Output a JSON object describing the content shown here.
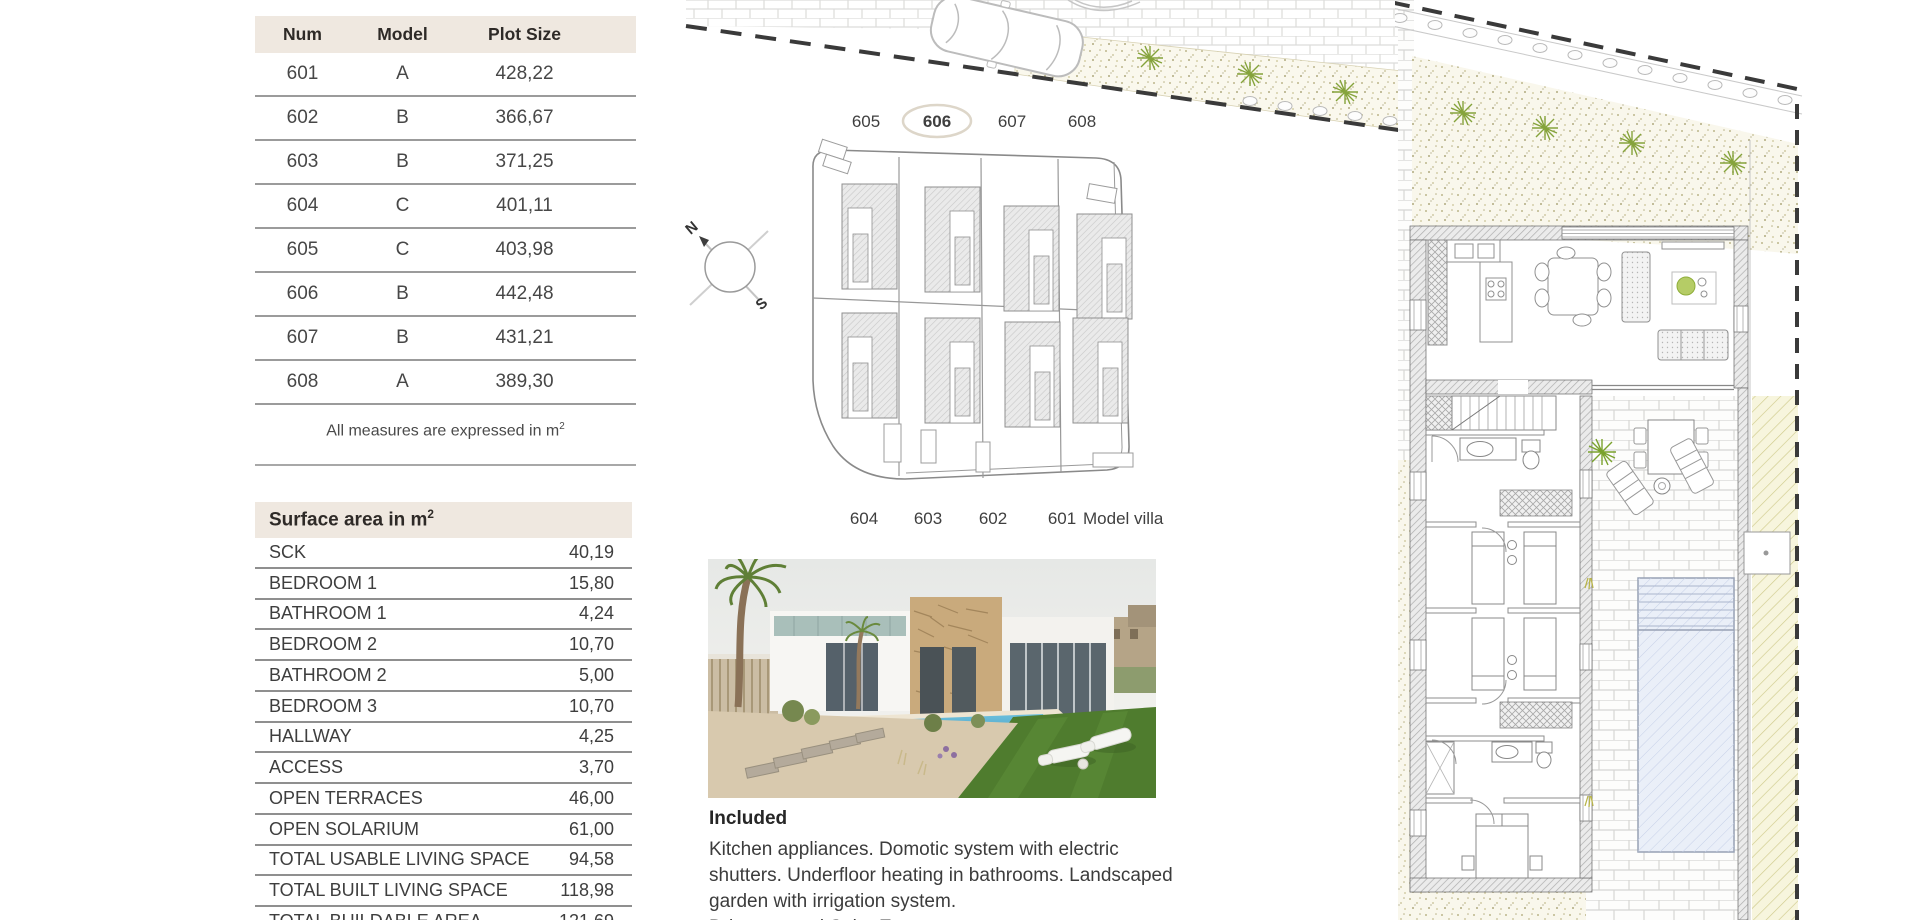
{
  "plot_table": {
    "headers": [
      "Num",
      "Model",
      "Plot Size"
    ],
    "rows": [
      [
        "601",
        "A",
        "428,22"
      ],
      [
        "602",
        "B",
        "366,67"
      ],
      [
        "603",
        "B",
        "371,25"
      ],
      [
        "604",
        "C",
        "401,11"
      ],
      [
        "605",
        "C",
        "403,98"
      ],
      [
        "606",
        "B",
        "442,48"
      ],
      [
        "607",
        "B",
        "431,21"
      ],
      [
        "608",
        "A",
        "389,30"
      ]
    ],
    "note": "All measures are expressed in m",
    "note_sup": "2"
  },
  "surface_table": {
    "title": "Surface area in m",
    "title_sup": "2",
    "rows": [
      [
        "SCK",
        "40,19"
      ],
      [
        "BEDROOM 1",
        "15,80"
      ],
      [
        "BATHROOM 1",
        "4,24"
      ],
      [
        "BEDROOM 2",
        "10,70"
      ],
      [
        "BATHROOM 2",
        "5,00"
      ],
      [
        "BEDROOM 3",
        "10,70"
      ],
      [
        "HALLWAY",
        "4,25"
      ],
      [
        "ACCESS",
        "3,70"
      ],
      [
        "OPEN TERRACES",
        "46,00"
      ],
      [
        "OPEN SOLARIUM",
        "61,00"
      ],
      [
        "TOTAL USABLE LIVING SPACE",
        "94,58"
      ],
      [
        "TOTAL BUILT LIVING SPACE",
        "118,98"
      ],
      [
        "TOTAL BUILDABLE AREA",
        "121,69"
      ]
    ]
  },
  "site_plan": {
    "top_labels": [
      "605",
      "606",
      "607",
      "608"
    ],
    "highlighted_unit": "606",
    "bottom_labels": [
      "604",
      "603",
      "602",
      "601"
    ],
    "model_villa_label": "Model villa",
    "compass_north": "N",
    "compass_south": "S"
  },
  "included": {
    "heading": "Included",
    "body": "Kitchen appliances. Domotic system with electric shutters. Underfloor heating in bathrooms. Landscaped garden with irrigation system.",
    "partial_line": "Driveway and Solar Energy."
  },
  "colors": {
    "table_header_bg": "#efe8e0",
    "table_line": "#8f8f8f",
    "text": "#3e3e3e",
    "plant_green": "#85a33b",
    "pool_fill": "#eaeff8",
    "boundary_dash": "#3a3a3a"
  }
}
